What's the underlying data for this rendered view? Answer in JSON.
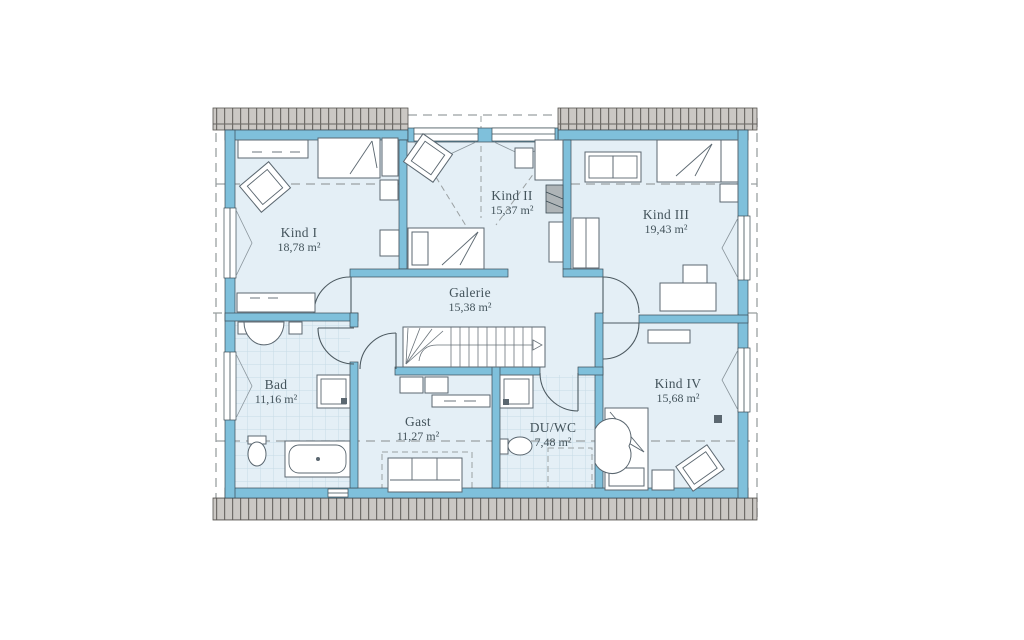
{
  "plan": {
    "type": "floor-plan",
    "floor": "attic-storey",
    "unit": "m²"
  },
  "colors": {
    "wall": "#7fc0db",
    "room": "#e4eff6",
    "hatch_fill": "#cbc8c4",
    "hatch_line": "#6f6c68",
    "outline": "#3a4b54",
    "furniture_line": "#5b6770",
    "label_text": "#44545c",
    "dash_line": "#9aa0a2",
    "tile_line": "#c6dbe6"
  },
  "rooms": {
    "kind1": {
      "name": "Kind I",
      "area": "18,78 m²"
    },
    "kind2": {
      "name": "Kind II",
      "area": "15,37 m²"
    },
    "kind3": {
      "name": "Kind III",
      "area": "19,43 m²"
    },
    "kind4": {
      "name": "Kind IV",
      "area": "15,68 m²"
    },
    "galerie": {
      "name": "Galerie",
      "area": "15,38 m²"
    },
    "bad": {
      "name": "Bad",
      "area": "11,16 m²"
    },
    "gast": {
      "name": "Gast",
      "area": "11,27 m²"
    },
    "duwc": {
      "name": "DU/WC",
      "area": "7,48 m²"
    }
  }
}
